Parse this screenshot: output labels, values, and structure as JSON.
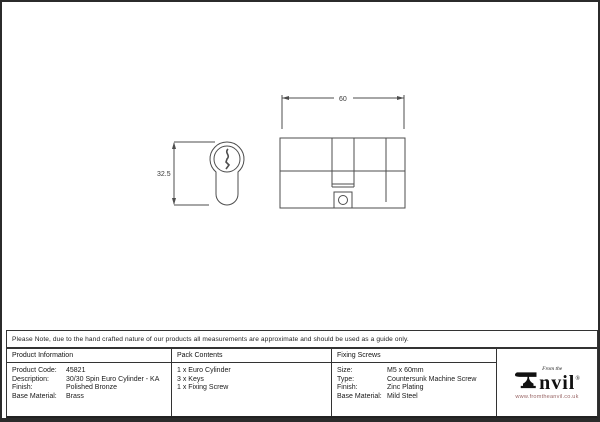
{
  "drawing": {
    "dim_width_label": "60",
    "dim_height_label": "32.5"
  },
  "note": "Please Note, due to the hand crafted nature of our products all measurements are approximate and should be used as a guide only.",
  "table": {
    "product_information": {
      "header": "Product Information",
      "rows": [
        {
          "label": "Product Code:",
          "value": "45821"
        },
        {
          "label": "Description:",
          "value": "30/30 Spin Euro Cylinder - KA"
        },
        {
          "label": "Finish:",
          "value": "Polished Bronze"
        },
        {
          "label": "Base Material:",
          "value": "Brass"
        }
      ]
    },
    "pack_contents": {
      "header": "Pack Contents",
      "items": [
        "1 x Euro Cylinder",
        "3 x Keys",
        "1 x Fixing Screw"
      ]
    },
    "fixing_screws": {
      "header": "Fixing Screws",
      "rows": [
        {
          "label": "Size:",
          "value": "M5 x 60mm"
        },
        {
          "label": "Type:",
          "value": "Countersunk Machine Screw"
        },
        {
          "label": "Finish:",
          "value": "Zinc Plating"
        },
        {
          "label": "Base Material:",
          "value": "Mild Steel"
        }
      ]
    }
  },
  "logo": {
    "tagline": "From the",
    "name": "nvil",
    "registered": "®",
    "website": "www.fromtheanvil.co.uk"
  },
  "colors": {
    "drawing_line": "#4d4d4d",
    "border": "#333333",
    "website_text": "#996666"
  }
}
